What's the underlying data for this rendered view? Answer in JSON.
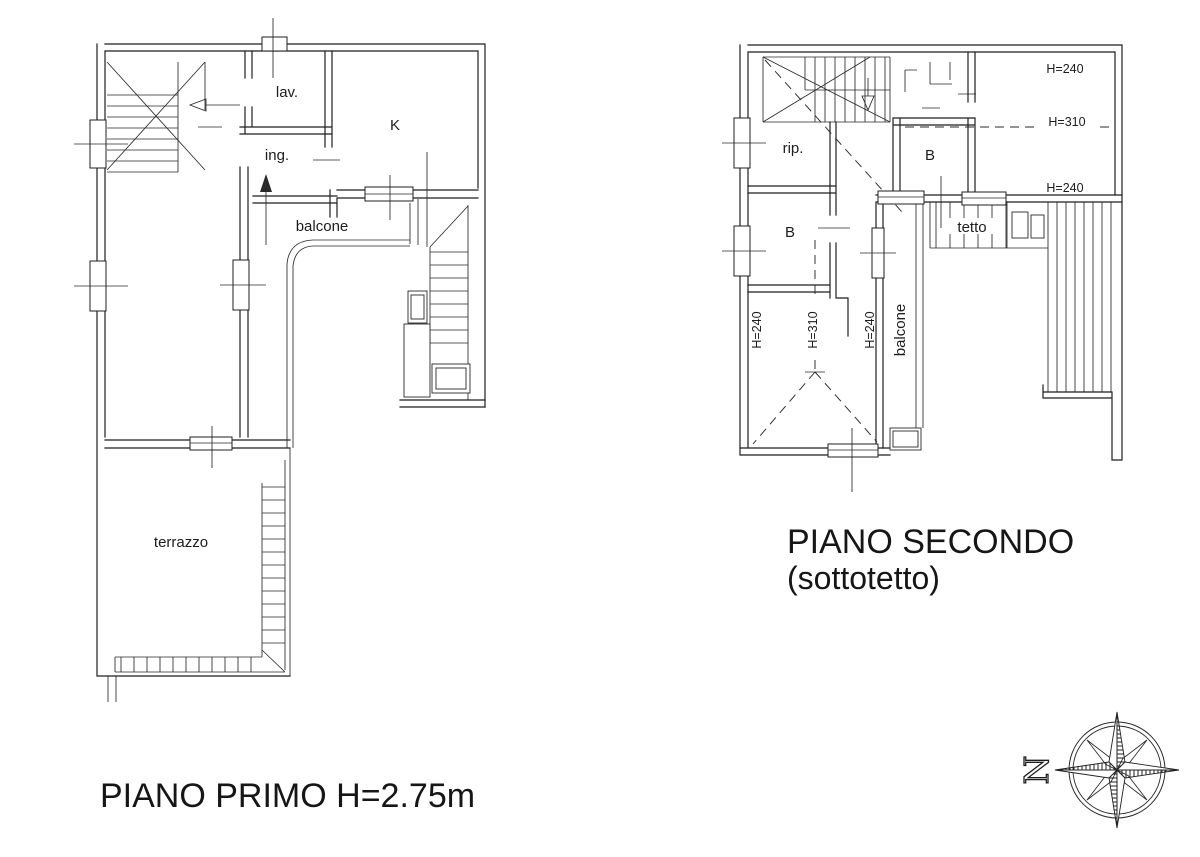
{
  "titles": {
    "floor1": "PIANO PRIMO H=2.75m",
    "floor2_line1": "PIANO SECONDO",
    "floor2_line2": "(sottotetto)"
  },
  "floor1": {
    "lav": "lav.",
    "kitchen": "K",
    "ing": "ing.",
    "balcone": "balcone",
    "terrazzo": "terrazzo"
  },
  "floor2": {
    "rip": "rip.",
    "bath_upper": "B",
    "bath_lower": "B",
    "tetto": "tetto",
    "balcone": "balcone",
    "h_top": "H=240",
    "h_mid": "H=310",
    "h_low": "H=240",
    "room_h_left": "H=240",
    "room_h_mid": "H=310",
    "room_h_right": "H=240"
  },
  "compass": {
    "north": "N"
  },
  "colors": {
    "line": "#1f1f1f",
    "background": "#ffffff"
  }
}
